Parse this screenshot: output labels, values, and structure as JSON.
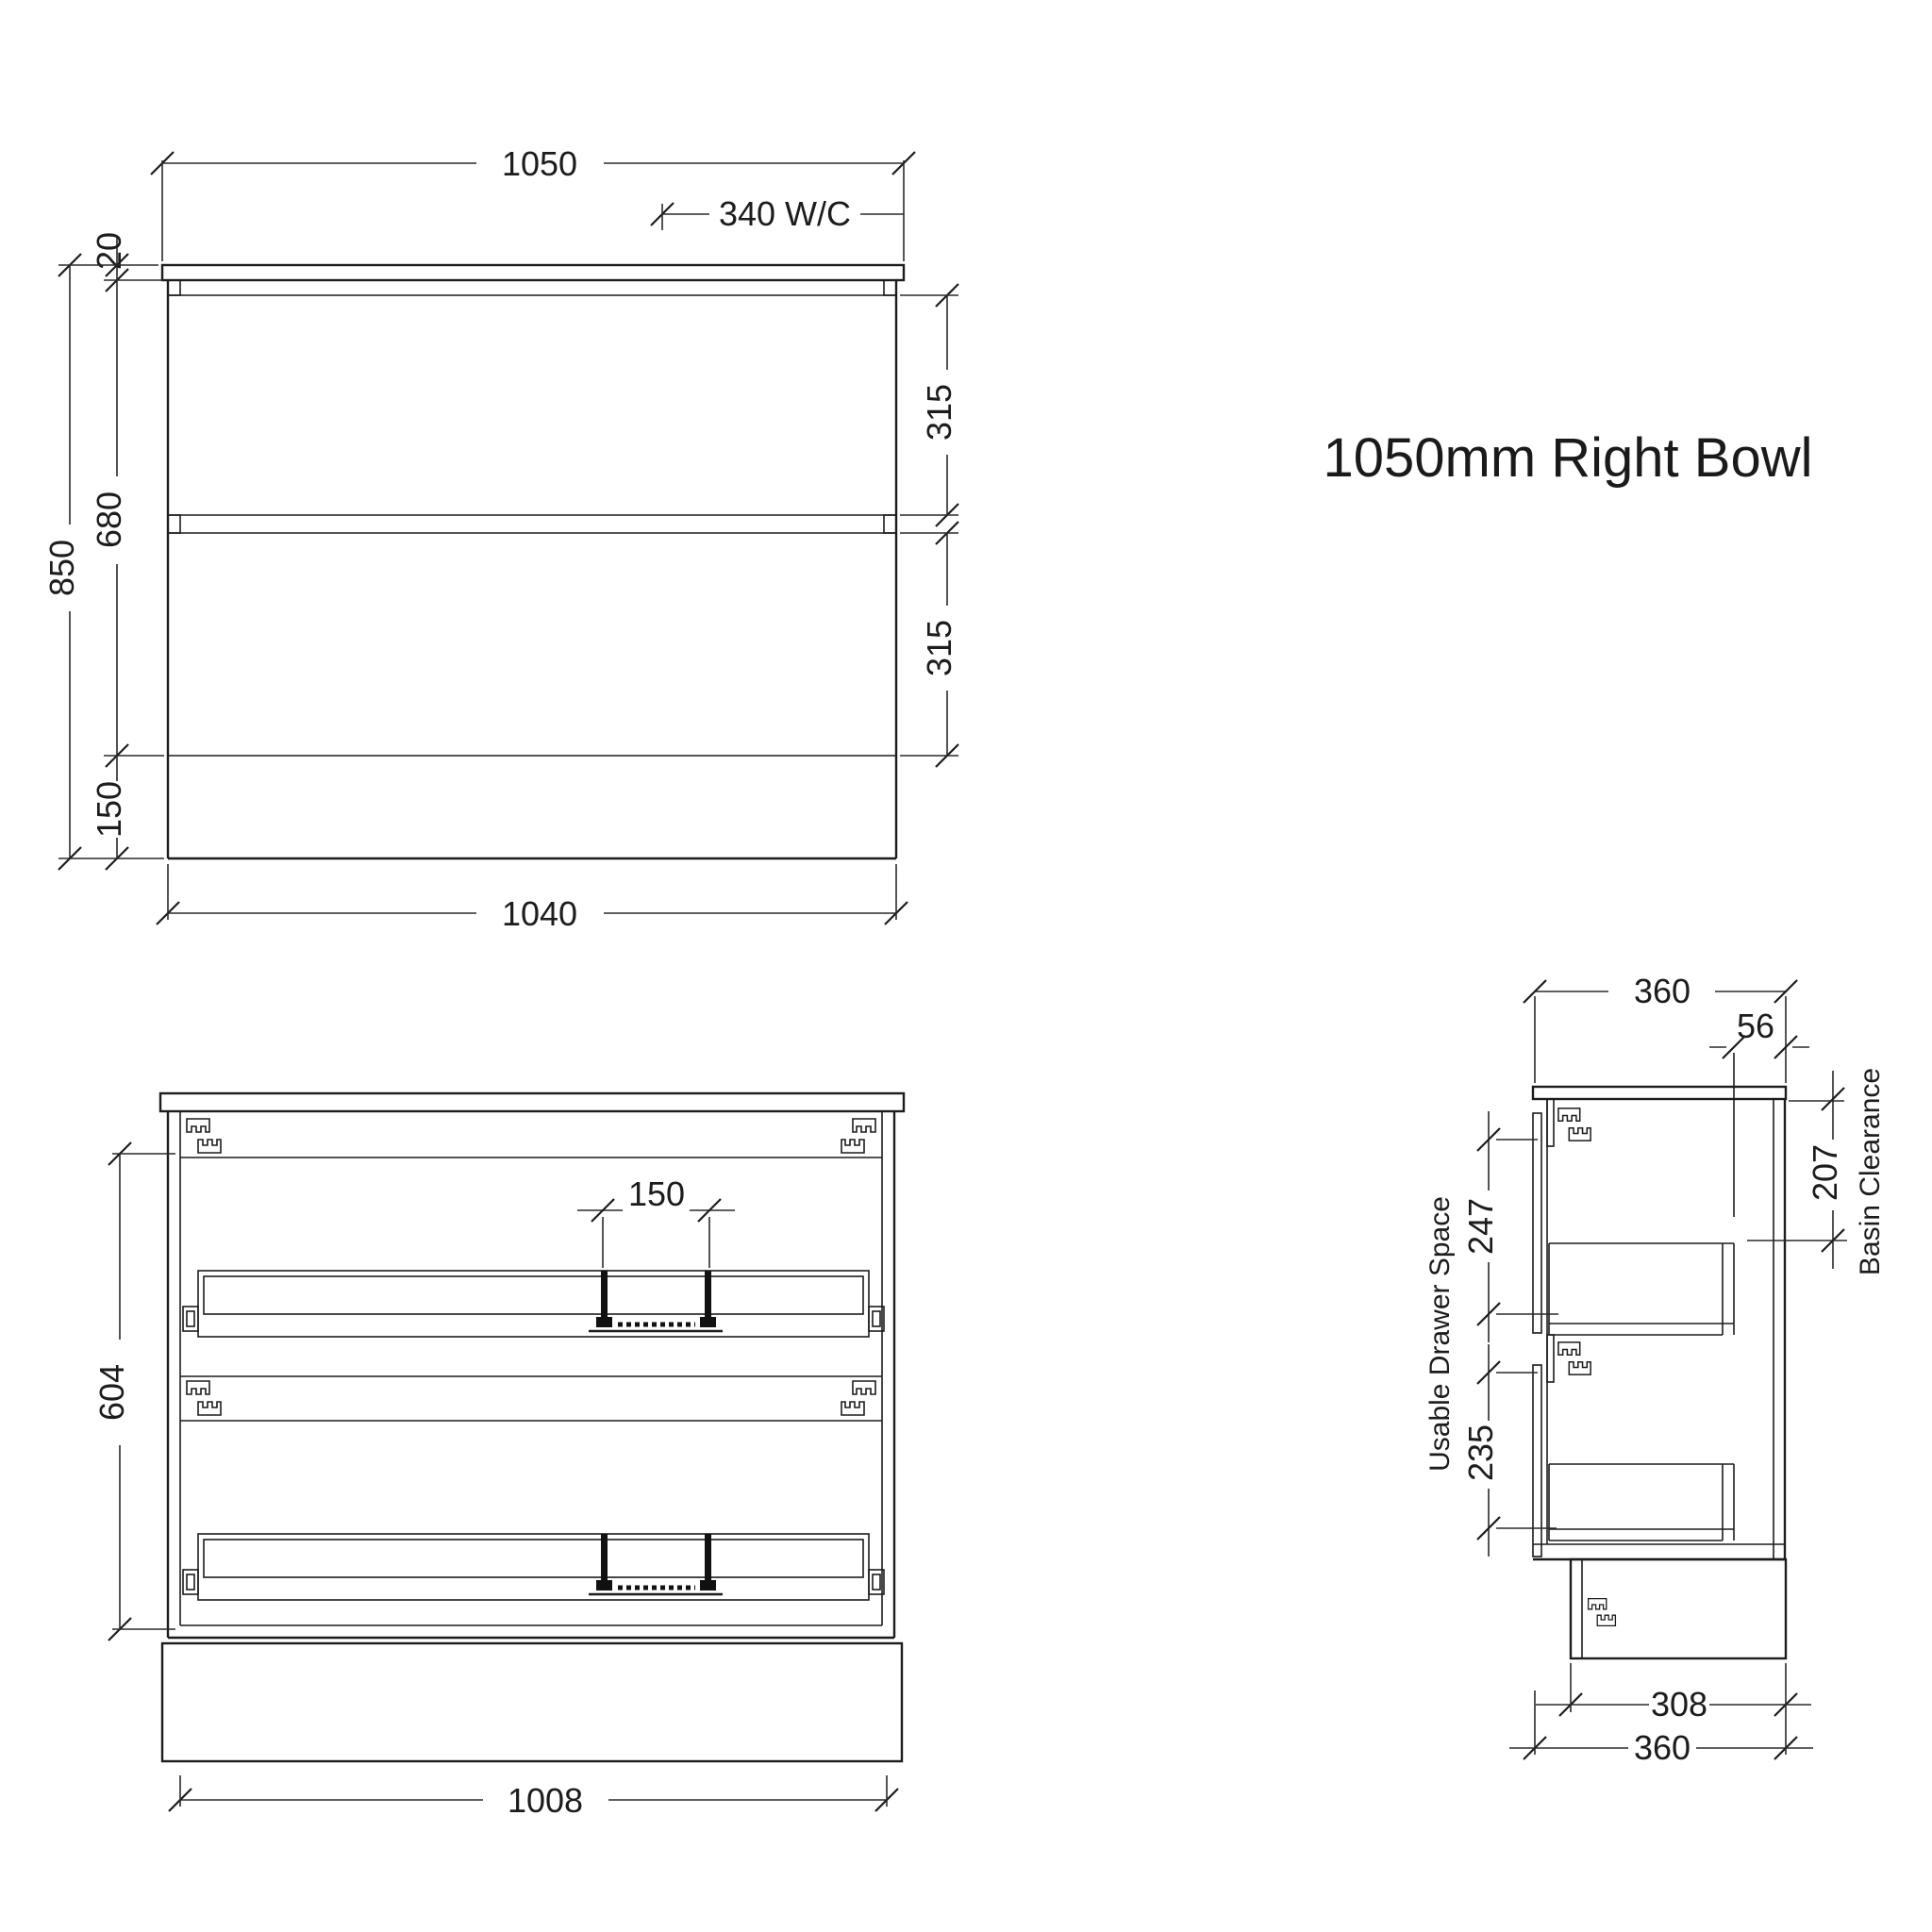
{
  "title": "1050mm Right Bowl",
  "front_view": {
    "width_top": "1050",
    "wc_offset": "340 W/C",
    "counter_thickness": "20",
    "total_height": "850",
    "body_height": "680",
    "kick_height": "150",
    "top_drawer_height": "315",
    "bottom_drawer_height": "315",
    "width_bottom": "1040"
  },
  "internal_view": {
    "internal_height": "604",
    "plumbing_gap": "150",
    "internal_width": "1008"
  },
  "side_view": {
    "depth_top": "360",
    "wc_setout": "56",
    "basin_clearance_value": "207",
    "basin_clearance_label": "Basin Clearance",
    "usable_drawer_space_label": "Usable Drawer Space",
    "top_drawer_space": "247",
    "bottom_drawer_space": "235",
    "kick_depth": "308",
    "depth_bottom": "360"
  },
  "colors": {
    "line": "#1c1c1c",
    "background": "#ffffff"
  }
}
